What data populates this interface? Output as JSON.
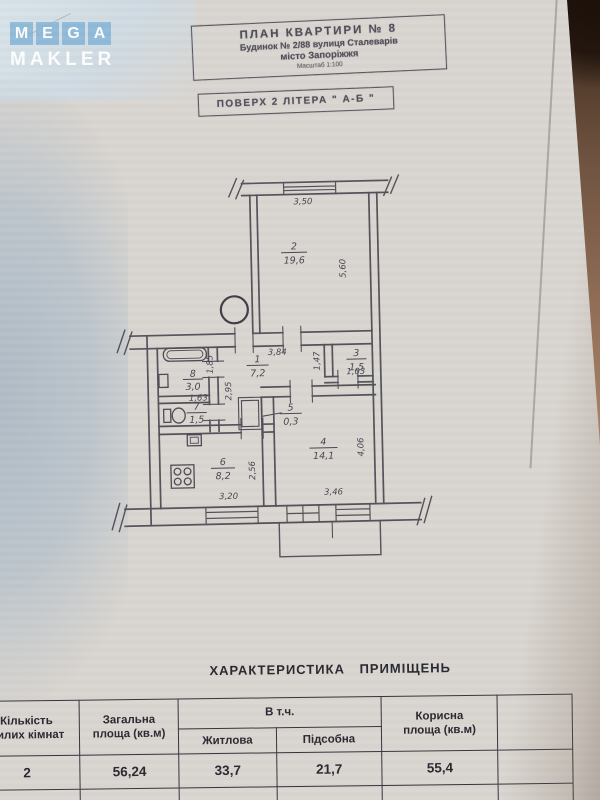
{
  "logo": {
    "letters": [
      "M",
      "E",
      "G",
      "A"
    ],
    "word": "MAKLER"
  },
  "header_box": {
    "line1": "ПЛАН  КВАРТИРИ  № 8",
    "line2": "Будинок № 2/88 вулиця Сталеварів",
    "line3": "місто  Запоріжжя",
    "line4": "Масштаб 1:100"
  },
  "floor_box": {
    "text": "ПОВЕРХ  2    ЛІТЕРА \" А-Б \""
  },
  "plan": {
    "rooms": {
      "r1": {
        "num": "1",
        "area": "7,2"
      },
      "r2": {
        "num": "2",
        "area": "19,6"
      },
      "r3": {
        "num": "3",
        "area": "1,5"
      },
      "r4": {
        "num": "4",
        "area": "14,1"
      },
      "r5": {
        "num": "5",
        "area": "0,3"
      },
      "r6": {
        "num": "6",
        "area": "8,2"
      },
      "r7": {
        "num": "7",
        "area": "1,5"
      },
      "r8": {
        "num": "8",
        "area": "3,0"
      }
    },
    "dims": {
      "room2_width": "3,50",
      "room2_height": "5,60",
      "hall_width": "3,84",
      "hall_height": "2,95",
      "room3_height": "1,47",
      "room3_width": "1,03",
      "bath_width": "1,63",
      "bath_height": "1,85",
      "kitchen_width": "3,20",
      "kitchen_height": "2,56",
      "room4_width": "3,46",
      "room4_height": "4,06"
    }
  },
  "table": {
    "title": "ХАРАКТЕРИСТИКА  ПРИМІЩЕНЬ",
    "headers": {
      "rooms_line1": "Кількість",
      "rooms_line2": "жилих кімнат",
      "total_line1": "Загальна",
      "total_line2": "площа (кв.м)",
      "including": "В т.ч.",
      "living": "Житлова",
      "auxiliary": "Підсобна",
      "useful_line1": "Корисна",
      "useful_line2": "площа (кв.м)"
    },
    "row": {
      "rooms": "2",
      "total": "56,24",
      "living": "33,7",
      "auxiliary": "21,7",
      "useful": "55,4"
    }
  }
}
